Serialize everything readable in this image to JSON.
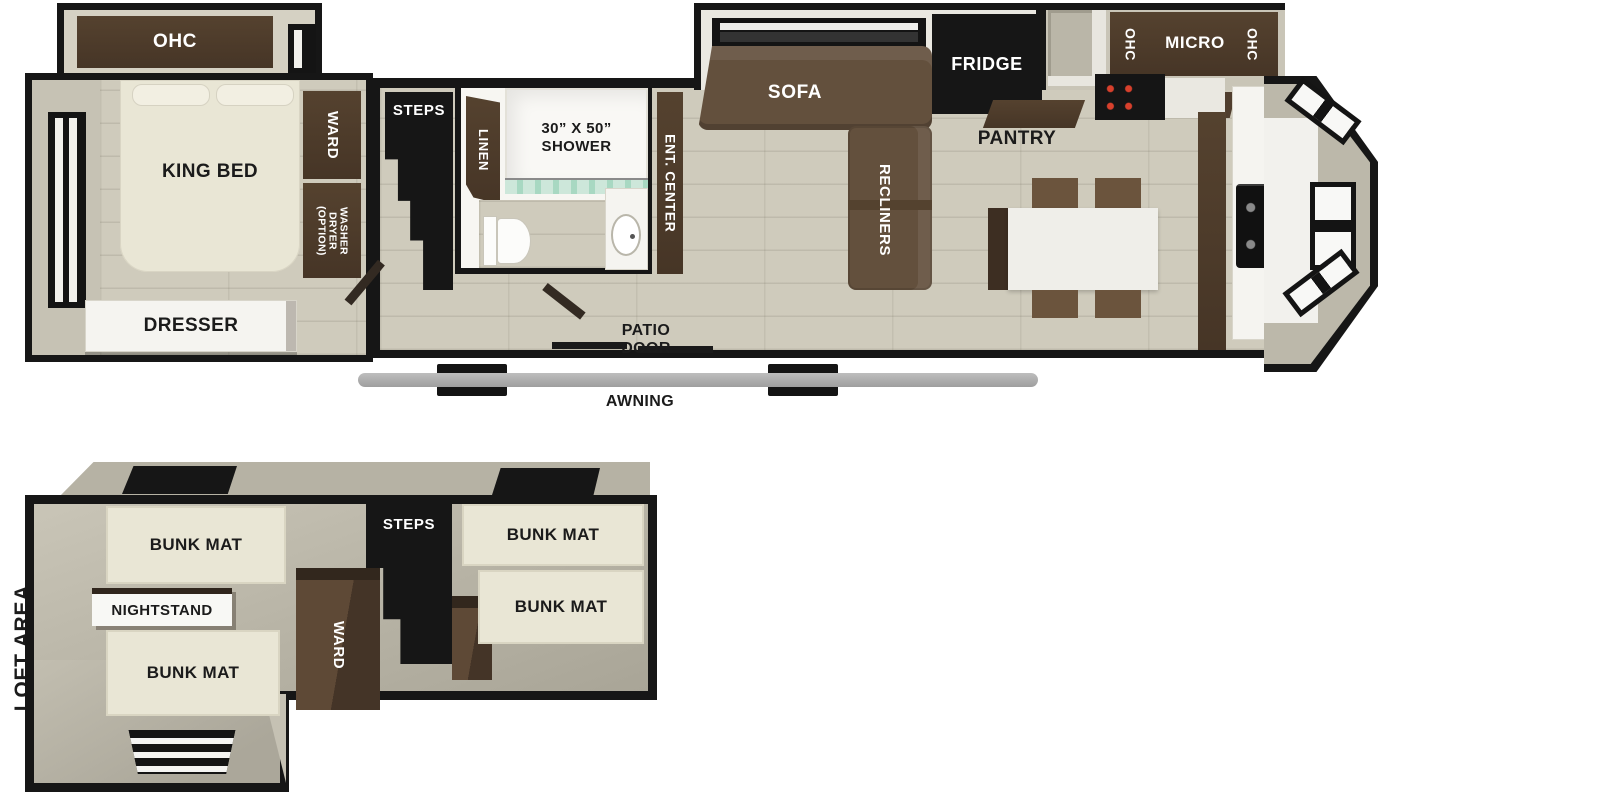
{
  "colors": {
    "wall_black": "#161616",
    "wall_tan": "#c6c2b4",
    "floor_plank": "#cfcbbc",
    "loft_floor": "#b7b3a5",
    "walnut_cabinet": "#4a392b",
    "sofa_brown": "#63503d",
    "mat_cream": "#e9e6d5",
    "awning_gray": "#ababab",
    "curtain_teal": "#a8d8c2",
    "burner_red": "#d8402c"
  },
  "main_floor": {
    "bedroom": {
      "ohc": "OHC",
      "king_bed": "KING BED",
      "ward": "WARD",
      "washer_dryer": "WASHER\nDRYER\n(OPTION)",
      "dresser": "DRESSER"
    },
    "hall": {
      "steps": "STEPS"
    },
    "bath": {
      "linen": "LINEN",
      "shower": "30” X 50”\nSHOWER"
    },
    "living": {
      "ent_center": "ENT. CENTER",
      "sofa": "SOFA",
      "recliners": "RECLINERS",
      "fridge": "FRIDGE",
      "pantry": "PANTRY"
    },
    "kitchen": {
      "ohc_left": "OHC",
      "micro": "MICRO",
      "ohc_right": "OHC"
    },
    "exterior": {
      "patio_door": "PATIO DOOR",
      "awning": "AWNING"
    }
  },
  "loft": {
    "area_label": "LOFT AREA",
    "bunk_mat_upper_left": "BUNK MAT",
    "nightstand": "NIGHTSTAND",
    "bunk_mat_lower_left": "BUNK MAT",
    "ward": "WARD",
    "steps": "STEPS",
    "bunk_mat_upper_right": "BUNK MAT",
    "bunk_mat_lower_right": "BUNK MAT"
  }
}
